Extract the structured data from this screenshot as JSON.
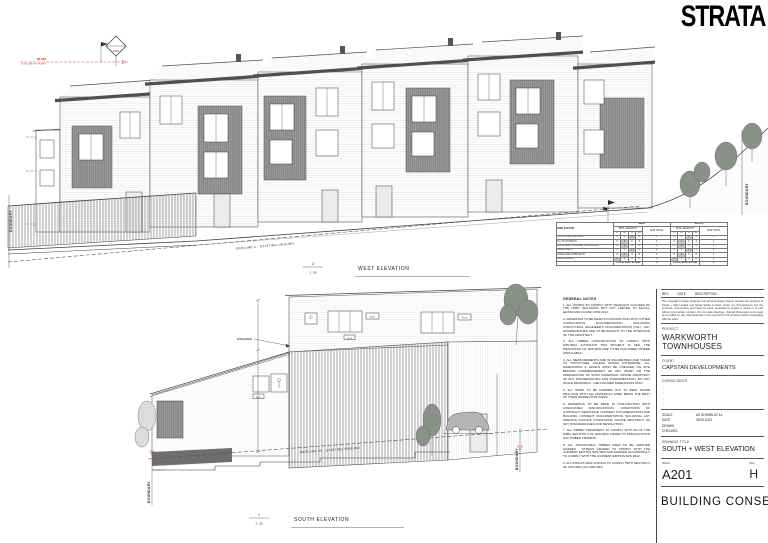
{
  "logo": "STRATA",
  "titleblock": {
    "rev_col": "REV",
    "date_col": "DATE",
    "desc_col": "DESCRIPTION",
    "copyright": "The copyright in these drawings and all work shown therein remains the property of Strata + SAA Limited and Strata Studio Limited. Under no circumstances can the contents, commentary and ideas be used, amended or copied in whole or in part without prior written consent. Do not scale drawings - figured dimensions to be used and verified on site. Discrepancies to be reported to the architect before proceeding with the work.",
    "project_label": "PROJECT",
    "project": "WARKWORTH TOWNHOUSES",
    "client_label": "CLIENT",
    "client": "CAPSTAN DEVELOPMENTS",
    "consultants_label": "CONSULTANTS",
    "dash": "-",
    "scale_label": "SCALE",
    "scale_value": "AS SHOWN AT A1",
    "date_label": "DATE",
    "date_value": "28.06.2023",
    "drawn_label": "DRAWN",
    "checked_label": "CHECKED",
    "drawing_title_label": "DRAWING TITLE",
    "drawing_title": "SOUTH + WEST ELEVATION",
    "sheet_label": "Sheet",
    "sheet_number": "A201",
    "rev_label": "Rev",
    "rev_value": "H",
    "stamp": "BUILDING CONSENT"
  },
  "west": {
    "number": "2",
    "scale": "1 : 50",
    "title": "WEST ELEVATION",
    "gridline": "GRIDLINE A - EXISTING GROUND",
    "boundary": "BOUNDARY",
    "datum_value": "8.281",
    "levels": [
      {
        "value": "28.638",
        "name": "U1 (PC) MAX ROOF APEX"
      },
      {
        "value": "24.935",
        "name": "U1 (PC) GUTTER LEVEL"
      },
      {
        "value": "24.554",
        "name": "U1 (PC) FIRST FLOOR"
      },
      {
        "value": "21.500",
        "name": "U1 (PC) GROUND LEVEL"
      }
    ]
  },
  "south": {
    "number": "1",
    "scale": "1 : 50",
    "title": "SOUTH ELEVATION",
    "gridline": "GRIDLINE 50 - EXISTING GROUND",
    "boundary": "BOUNDARY",
    "spreader": "SPREADER",
    "tags": {
      "w07": "W-07",
      "w06": "W-06",
      "w05": "W-05",
      "w01": "W-01"
    }
  },
  "risk": {
    "factor": "RISK FACTOR",
    "groups": [
      "WEST",
      "SOUTH"
    ],
    "severity": "RISK SEVERITY",
    "cols": [
      "L",
      "M",
      "H",
      "VH"
    ],
    "sub_label": "SUB TOTAL",
    "rows": [
      {
        "label": "WIND ZONE (NZS:3604)",
        "vals": [
          "0",
          "0",
          "1",
          "2"
        ],
        "sub": "1"
      },
      {
        "label": "No. OF STOREYS",
        "vals": [
          "0",
          "1",
          "2",
          "4"
        ],
        "sub": "1"
      },
      {
        "label": "ROOF/WALL INTERSECTION DESIGN",
        "vals": [
          "0",
          "1",
          "3",
          "5"
        ],
        "sub": "1"
      },
      {
        "label": "EAVES WIDTH",
        "vals": [
          "0",
          "1",
          "2",
          "5"
        ],
        "sub": "2"
      },
      {
        "label": "ENVELOPE COMPLEXITY",
        "vals": [
          "0",
          "1",
          "3",
          "6"
        ],
        "sub": "1"
      },
      {
        "label": "DECK DESIGN",
        "vals": [
          "0",
          "2",
          "4",
          "6"
        ],
        "sub": "0"
      }
    ],
    "total_label": "TOTAL RISK SCORE",
    "total": "6"
  },
  "notes": {
    "title": "GENERAL NOTES",
    "items": [
      "1. ALL WORKS TO COMPLY WITH RELEVANT CLAUSES OF THE NZBC INCLUDING BUT NOT LIMITED TO E2/AS1, E2/AS3 AND CCANZ CP01:2014.",
      "2. DRAWINGS TO BE READ IN CONJUNCTION WITH OTHER CONSULTANTS DOCUMENTATION INCLUDING STRUCTURAL ENGINEER'S DOCUMENTATION (S.E.). ANY DISCREPANCIES ARE TO BE BOUGHT TO THE ATTENTION OF THE ARCHITECT.",
      "3. ALL TIMBER CONSTRUCTION TO COMPLY WITH NZS:3604. ALTHOUGH THIS PROJECT IS SED, THE PRINCIPLES OF NZS:3604 ARE TO BE FOLLOWED WHERE APPLICABLE.",
      "4. ALL MEASUREMENTS ARE IN MILLIMETRES AND TAKEN TO STRUCTURE UNLESS NOTED OTHERWISE. ALL DIMENSIONS & LEVELS MUST BE CHECKED ON SITE BEFORE COMMENCEMENT OF ANY WORK OR THE PREPARATION OF SHOP DRAWINGS. ADVISE ARCHITECT OF ANY DISCREPANCIES FOR INTERPRETATION. DO NOT SCALE DRAWINGS - USE FIGURED DIMENSIONS ONLY.",
      "5. ALL WORK TO BE CARRIED OUT TO BEST TRADE PRACTICE WITH ALL MATERIALS USED BEING THE BEST OF THEIR RESPECTIVE KINDS.",
      "6. DRAWINGS TO BE READ IN CONJUNCTION WITH ASSOCIATED SPECIFICATIONS, CONDITIONS OF CONTRACT, RESOURCE CONSENT DOCUMENTATION AND BUILDING CONSENT DOCUMENTATION INCLUDING ANY SPECIFIC COUNCIL CONDITIONS. ADVISE ARCHITECT OF ANY DISCREPANCIES FOR RESOLUTION.",
      "7. ALL TIMBER TREATMENT TO COMPLY WITH B2 OF THE NZBC SECTION 4 OF NZS:3604. REFER TO SPECIFICATION (A0) TIMBER FRAMING.",
      "8. ALL STRUCTURAL TIMBER USED TO BE VERIFIED GRADES - STRESS GRADED TO COMPLY WITH THE CURRENT EDITION NZS:3603 AND MARKED ACCORDINGLY TO COMPLY WITH THE CURRENT EDITION NZS:3622.",
      "9. ALL STRUCTURAL FIXINGS TO COMPLY WITH SECTION 4 OF NZS:3604 (SG AND 32D)."
    ]
  }
}
